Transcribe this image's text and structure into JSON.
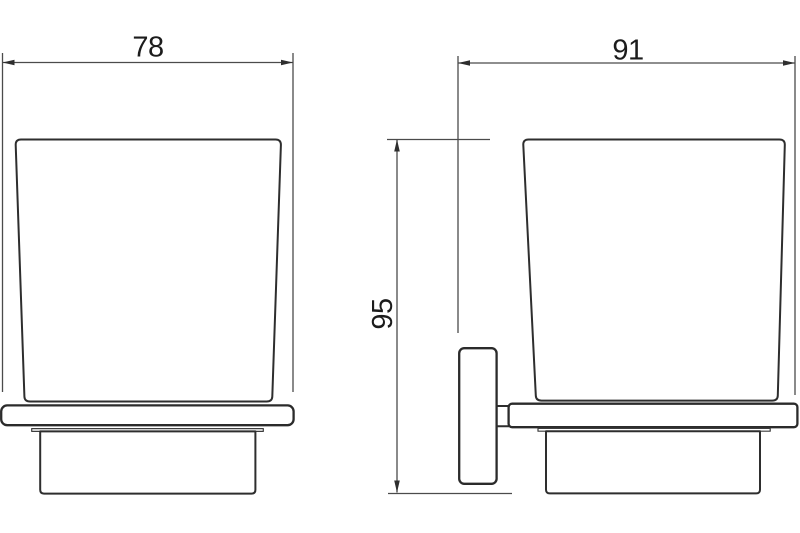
{
  "drawing": {
    "dimensions": {
      "front_width": "78",
      "side_depth": "91",
      "height": "95"
    },
    "colors": {
      "object_line": "#2e2e2e",
      "dimension_line": "#4b4b4b",
      "label_text": "#1c1c1c",
      "background": "#ffffff"
    }
  }
}
